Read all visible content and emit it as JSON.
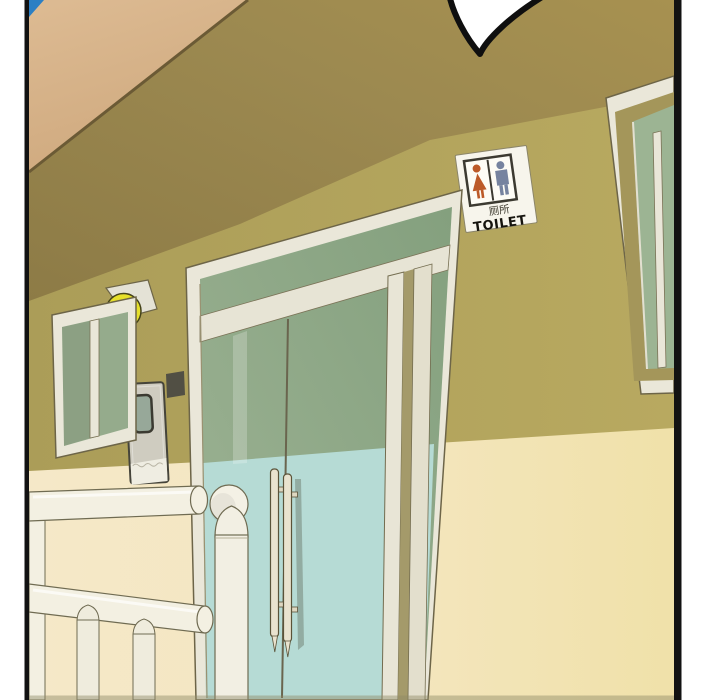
{
  "panel": {
    "description": "Webtoon comic panel: low-angle exterior view of a building with a glass double-door entrance, a toilet sign on the wall, two windows, a yellow wall lamp, a small utility door and a white railing. A speech-bubble tail is cut off at the top edge.",
    "speech_bubble_text": "",
    "toilet_sign": {
      "chinese": "厕所",
      "english": "TOILET"
    },
    "colors": {
      "sky_blue": "#2b7fc4",
      "eave_tan": "#d7b28a",
      "shadow_band_khaki": "#9a8750",
      "wall_olive": "#b1a25a",
      "sunlit_wall_left": "#f5e8c7",
      "sunlit_wall_right": "#f1e2ab",
      "glass_shade_green": "#95ab8c",
      "glass_sunlit_cyan": "#b6dbd5",
      "frame_white": "#eae7d9",
      "mullion_white": "#e7e4d5",
      "stile_shadow": "#a49a6a",
      "railing_white": "#f3f0e2",
      "lamp_yellow": "#e6e02a",
      "utility_door_gray": "#cfccc0",
      "electrical_box_gray": "#514f44",
      "sign_bg": "#f7f5ec",
      "sign_female_red": "#bc5a28",
      "sign_male_blue": "#76839f",
      "bubble_white": "#ffffff",
      "outline_black": "#121212"
    }
  }
}
